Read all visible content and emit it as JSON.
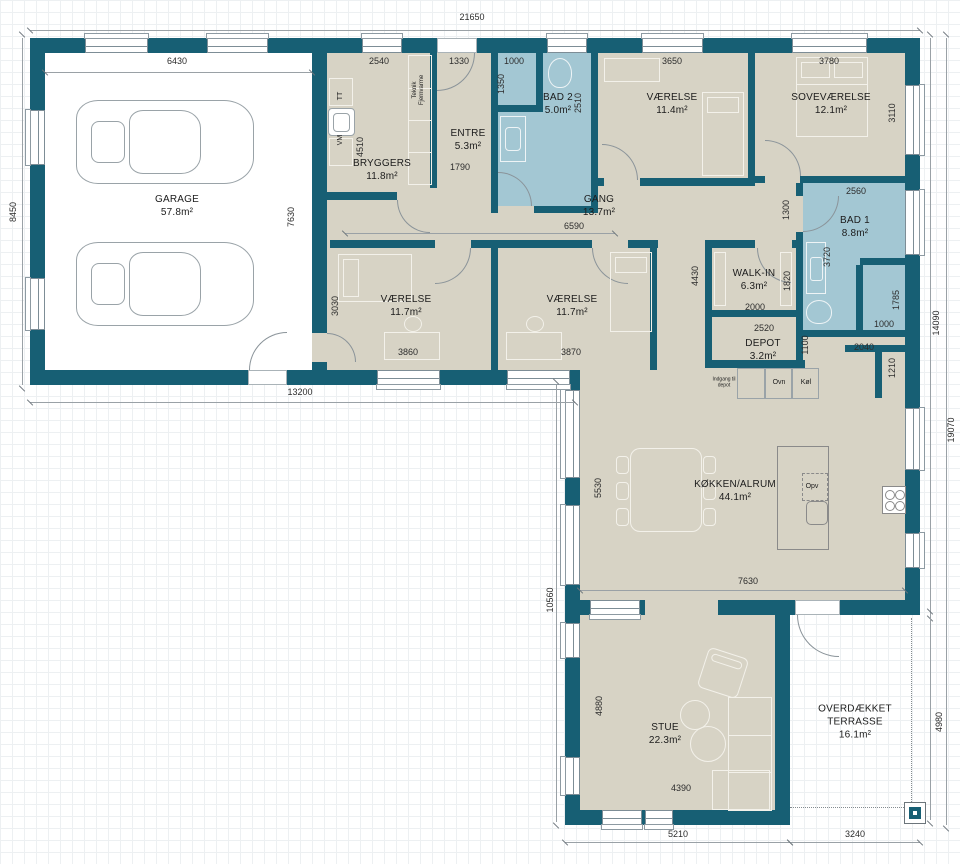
{
  "plan": {
    "colors": {
      "wall": "#175f74",
      "room_fill": "#d7d3c5",
      "wet_room_fill": "#a3c7d3",
      "garage_fill": "#ffffff",
      "dim_line": "#9aa1a6",
      "dim_text": "#2d2d2d"
    },
    "rooms": [
      {
        "name": "GARAGE",
        "area": "57.8m²",
        "x": 177,
        "y": 206
      },
      {
        "name": "BRYGGERS",
        "area": "11.8m²",
        "x": 382,
        "y": 170
      },
      {
        "name": "ENTRE",
        "area": "5.3m²",
        "x": 468,
        "y": 140
      },
      {
        "name": "BAD 2",
        "area": "5.0m²",
        "x": 558,
        "y": 104
      },
      {
        "name": "VÆRELSE",
        "area": "11.4m²",
        "x": 672,
        "y": 104
      },
      {
        "name": "SOVEVÆRELSE",
        "area": "12.1m²",
        "x": 831,
        "y": 104
      },
      {
        "name": "GANG",
        "area": "13.7m²",
        "x": 599,
        "y": 206
      },
      {
        "name": "BAD 1",
        "area": "8.8m²",
        "x": 855,
        "y": 227
      },
      {
        "name": "WALK-IN",
        "area": "6.3m²",
        "x": 754,
        "y": 280
      },
      {
        "name": "VÆRELSE",
        "area": "11.7m²",
        "x": 406,
        "y": 306
      },
      {
        "name": "VÆRELSE",
        "area": "11.7m²",
        "x": 572,
        "y": 306
      },
      {
        "name": "DEPOT",
        "area": "3.2m²",
        "x": 763,
        "y": 350
      },
      {
        "name": "KØKKEN/ALRUM",
        "area": "44.1m²",
        "x": 735,
        "y": 491
      },
      {
        "name": "STUE",
        "area": "22.3m²",
        "x": 665,
        "y": 734
      },
      {
        "name": "OVERDÆKKET TERRASSE",
        "area": "16.1m²",
        "x": 855,
        "y": 722,
        "w": 95
      }
    ],
    "dimensions": [
      {
        "t": "21650",
        "x": 472,
        "y": 17,
        "o": "h"
      },
      {
        "t": "6430",
        "x": 177,
        "y": 61,
        "o": "h"
      },
      {
        "t": "2540",
        "x": 379,
        "y": 61,
        "o": "h"
      },
      {
        "t": "1330",
        "x": 459,
        "y": 61,
        "o": "h"
      },
      {
        "t": "1000",
        "x": 514,
        "y": 61,
        "o": "h"
      },
      {
        "t": "3650",
        "x": 672,
        "y": 61,
        "o": "h"
      },
      {
        "t": "3780",
        "x": 829,
        "y": 61,
        "o": "h"
      },
      {
        "t": "8450",
        "x": 13,
        "y": 212,
        "o": "v"
      },
      {
        "t": "1350",
        "x": 501,
        "y": 84,
        "o": "v"
      },
      {
        "t": "2510",
        "x": 578,
        "y": 103,
        "o": "v"
      },
      {
        "t": "3110",
        "x": 892,
        "y": 113,
        "o": "v"
      },
      {
        "t": "4510",
        "x": 360,
        "y": 147,
        "o": "v"
      },
      {
        "t": "7630",
        "x": 291,
        "y": 217,
        "o": "v"
      },
      {
        "t": "1790",
        "x": 460,
        "y": 167,
        "o": "h"
      },
      {
        "t": "6590",
        "x": 574,
        "y": 226,
        "o": "h"
      },
      {
        "t": "1300",
        "x": 786,
        "y": 210,
        "o": "v"
      },
      {
        "t": "2560",
        "x": 856,
        "y": 191,
        "o": "h"
      },
      {
        "t": "3030",
        "x": 335,
        "y": 306,
        "o": "v"
      },
      {
        "t": "3860",
        "x": 408,
        "y": 352,
        "o": "h"
      },
      {
        "t": "3870",
        "x": 571,
        "y": 352,
        "o": "h"
      },
      {
        "t": "4430",
        "x": 695,
        "y": 276,
        "o": "v"
      },
      {
        "t": "1820",
        "x": 787,
        "y": 281,
        "o": "v"
      },
      {
        "t": "2000",
        "x": 755,
        "y": 307,
        "o": "h"
      },
      {
        "t": "3720",
        "x": 827,
        "y": 257,
        "o": "v"
      },
      {
        "t": "1785",
        "x": 896,
        "y": 300,
        "o": "v"
      },
      {
        "t": "1000",
        "x": 884,
        "y": 324,
        "o": "h"
      },
      {
        "t": "2520",
        "x": 764,
        "y": 328,
        "o": "h"
      },
      {
        "t": "1100",
        "x": 805,
        "y": 345,
        "o": "v"
      },
      {
        "t": "2040",
        "x": 864,
        "y": 347,
        "o": "h"
      },
      {
        "t": "1210",
        "x": 892,
        "y": 368,
        "o": "v"
      },
      {
        "t": "13200",
        "x": 300,
        "y": 392,
        "o": "h"
      },
      {
        "t": "14090",
        "x": 936,
        "y": 323,
        "o": "v"
      },
      {
        "t": "19070",
        "x": 951,
        "y": 430,
        "o": "v"
      },
      {
        "t": "10560",
        "x": 550,
        "y": 600,
        "o": "v"
      },
      {
        "t": "5530",
        "x": 598,
        "y": 488,
        "o": "v"
      },
      {
        "t": "7630",
        "x": 748,
        "y": 581,
        "o": "h"
      },
      {
        "t": "4880",
        "x": 599,
        "y": 706,
        "o": "v"
      },
      {
        "t": "4390",
        "x": 681,
        "y": 788,
        "o": "h"
      },
      {
        "t": "4980",
        "x": 939,
        "y": 722,
        "o": "v"
      },
      {
        "t": "5210",
        "x": 678,
        "y": 834,
        "o": "h"
      },
      {
        "t": "3240",
        "x": 855,
        "y": 834,
        "o": "h"
      }
    ],
    "fixtures": [
      {
        "t": "TT",
        "x": 341,
        "y": 96,
        "r": -90,
        "s": 7
      },
      {
        "t": "VM",
        "x": 341,
        "y": 140,
        "r": -90,
        "s": 7
      },
      {
        "t": "Teknik\nFjernvarme",
        "x": 419,
        "y": 90,
        "r": -90,
        "s": 6
      },
      {
        "t": "Opv",
        "x": 812,
        "y": 487,
        "r": 0,
        "s": 7
      },
      {
        "t": "Ovn",
        "x": 779,
        "y": 383,
        "r": 0,
        "s": 7
      },
      {
        "t": "Køl",
        "x": 806,
        "y": 383,
        "r": 0,
        "s": 7
      },
      {
        "t": "Indgang til\ndepot",
        "x": 724,
        "y": 383,
        "r": 0,
        "s": 5
      }
    ]
  }
}
